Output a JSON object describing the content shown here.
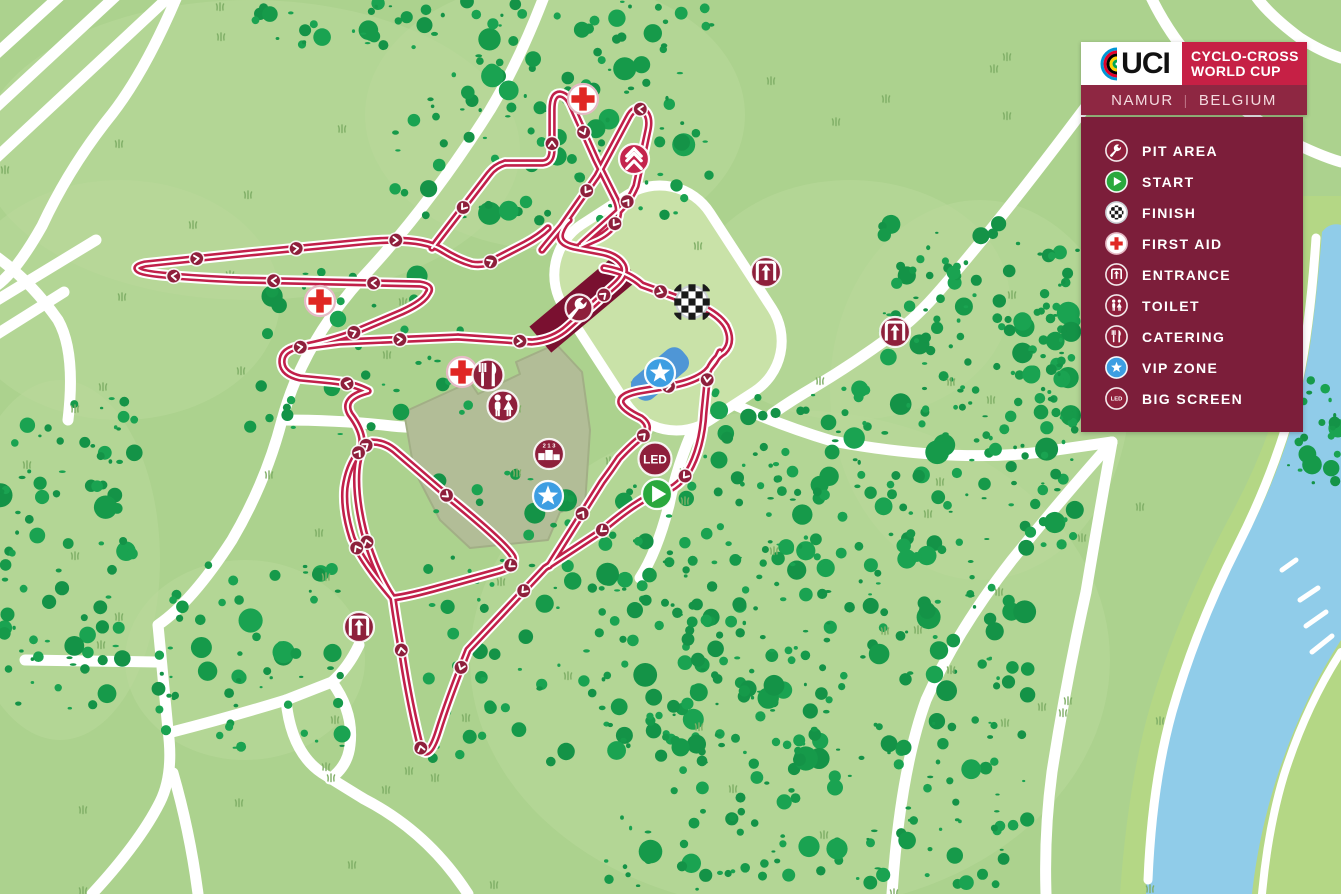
{
  "header": {
    "uci_wordmark": "UCI",
    "event_line1": "CYCLO-CROSS",
    "event_line2": "WORLD CUP",
    "location": "NAMUR",
    "separator": "|",
    "country": "BELGIUM"
  },
  "legend": {
    "items": [
      {
        "id": "pit-area",
        "icon": "wrench-icon",
        "label": "PIT AREA"
      },
      {
        "id": "start",
        "icon": "play-icon",
        "label": "START"
      },
      {
        "id": "finish",
        "icon": "checkered-icon",
        "label": "FINISH"
      },
      {
        "id": "first-aid",
        "icon": "red-cross-icon",
        "label": "FIRST AID"
      },
      {
        "id": "entrance",
        "icon": "door-arrow-icon",
        "label": "ENTRANCE"
      },
      {
        "id": "toilet",
        "icon": "man-woman-icon",
        "label": "TOILET"
      },
      {
        "id": "catering",
        "icon": "fork-knife-icon",
        "label": "CATERING"
      },
      {
        "id": "vip-zone",
        "icon": "star-icon",
        "label": "VIP ZONE"
      },
      {
        "id": "big-screen",
        "icon": "led-icon",
        "label": "BIG SCREEN"
      }
    ]
  },
  "map": {
    "big_screen_text": "LED",
    "podium_numbers": "2 1 3",
    "markers": [
      {
        "type": "first-aid",
        "x": 583,
        "y": 99
      },
      {
        "type": "climb",
        "x": 634,
        "y": 159
      },
      {
        "type": "first-aid",
        "x": 320,
        "y": 301
      },
      {
        "type": "entrance",
        "x": 766,
        "y": 272
      },
      {
        "type": "finish",
        "x": 692,
        "y": 302
      },
      {
        "type": "pit",
        "x": 579,
        "y": 308
      },
      {
        "type": "entrance",
        "x": 895,
        "y": 332
      },
      {
        "type": "first-aid",
        "x": 462,
        "y": 372
      },
      {
        "type": "catering",
        "x": 488,
        "y": 375
      },
      {
        "type": "toilet",
        "x": 503,
        "y": 406
      },
      {
        "type": "vip",
        "x": 660,
        "y": 373
      },
      {
        "type": "podium",
        "x": 549,
        "y": 454
      },
      {
        "type": "big-screen",
        "x": 655,
        "y": 459
      },
      {
        "type": "vip",
        "x": 548,
        "y": 496
      },
      {
        "type": "start",
        "x": 657,
        "y": 494
      },
      {
        "type": "entrance",
        "x": 359,
        "y": 627
      }
    ],
    "colors": {
      "base_green": "#acd28e",
      "light_green": "#bedc9f",
      "forest_bg": "#b9d99b",
      "tree_green": "#179a4b",
      "field_green": "#c9e2a8",
      "road_white": "#ffffff",
      "track_red": "#c1204a",
      "marker_maroon": "#8e1f3b",
      "pit_band": "#7a1030",
      "legend_maroon": "#7c1e3a",
      "brand_red": "#c62045",
      "location_bar": "#8e2742",
      "start_green": "#2aa83d",
      "vip_blue": "#3d9ee2",
      "first_aid_red": "#e02724",
      "water_blue": "#90cce9",
      "river_bank": "#b4d785",
      "uci_rainbow": [
        "#0096d6",
        "#e4002b",
        "#000000",
        "#ffd100",
        "#00a651"
      ]
    }
  }
}
